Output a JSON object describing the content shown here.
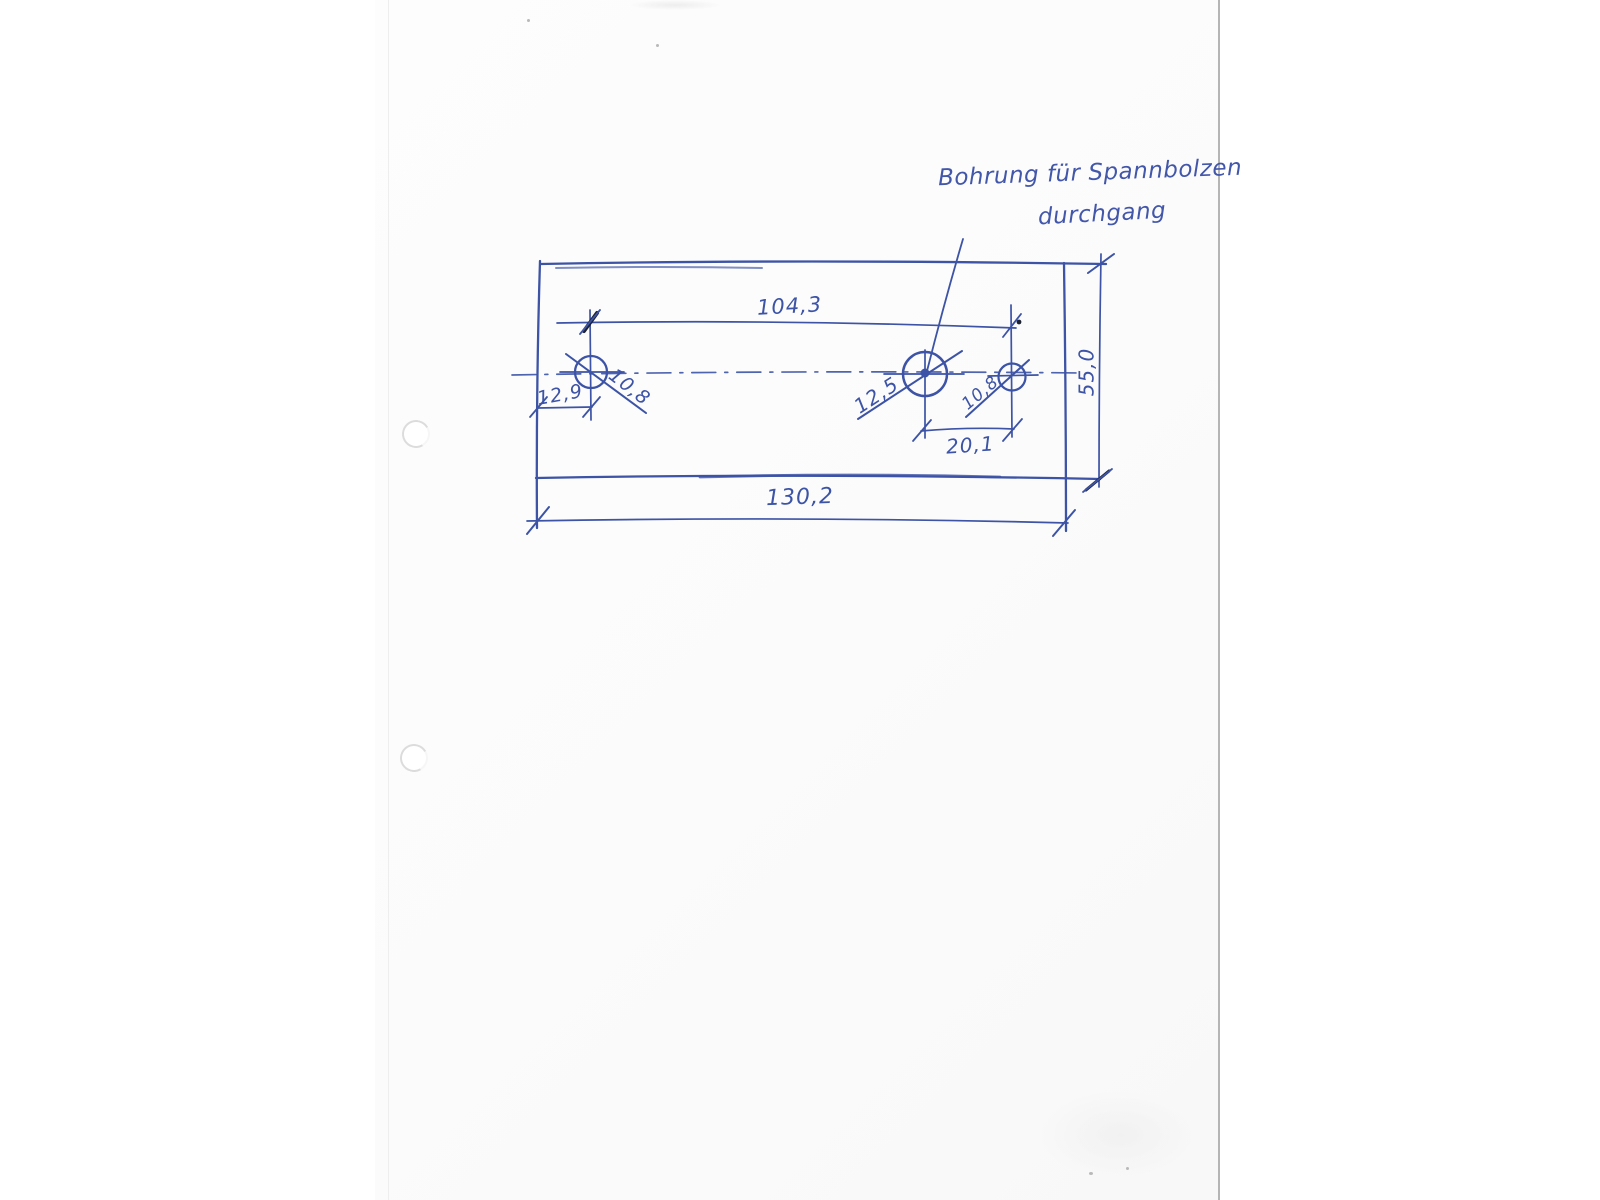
{
  "note": {
    "line1": "Bohrung für Spannbolzen",
    "line2": "durchgang"
  },
  "dims": {
    "hole_span": "104,3",
    "overall_width": "130,2",
    "plate_height": "55,0",
    "left_hole_offset": "12,9",
    "left_hole_dia": "10,8",
    "center_hole_dia": "12,5",
    "right_hole_dia": "10,8",
    "hole_pitch": "20,1"
  },
  "colors": {
    "ink": "#3c53a6",
    "ink_dark": "#1c2230",
    "paper": "#fcfcfc",
    "page_edge": "#b5b5b5",
    "punch_ring": "#dcdcdc"
  }
}
